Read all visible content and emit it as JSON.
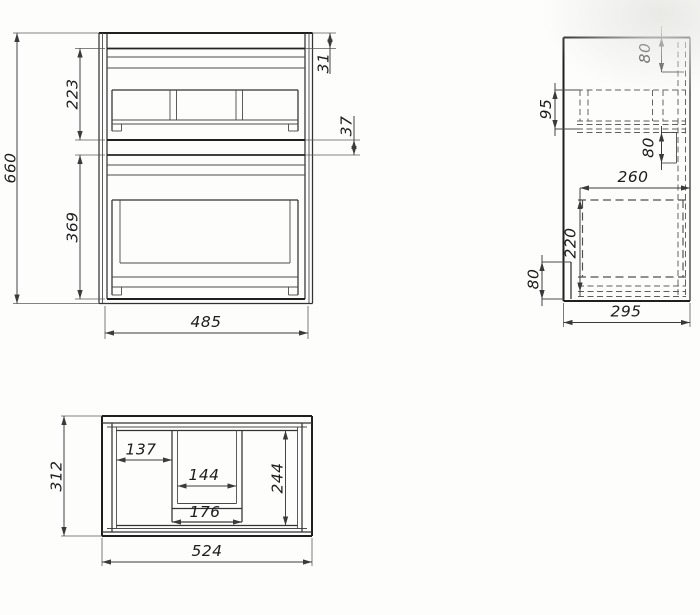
{
  "page": {
    "background_color": "#fdfdfc",
    "ink_color": "#2b2b2b"
  },
  "drawing": {
    "type": "technical-drawing",
    "description": "cabinet dimension drawing with three orthographic views",
    "views": {
      "front": {
        "name": "front-view",
        "dims": {
          "overall_height": "660",
          "upper_section": "223",
          "lower_section": "369",
          "top_gap": "31",
          "middle_gap": "37",
          "width": "485"
        }
      },
      "side": {
        "name": "side-view",
        "dims": {
          "top_offset": "80",
          "rail_height": "95",
          "middle_offset": "80",
          "inner_depth": "260",
          "drawer_height": "220",
          "bottom_offset": "80",
          "depth": "295"
        }
      },
      "top": {
        "name": "top-view",
        "dims": {
          "depth": "312",
          "left_width": "137",
          "tray_inner_width": "144",
          "tray_outer_width": "176",
          "right_depth": "244",
          "width": "524"
        }
      }
    }
  }
}
